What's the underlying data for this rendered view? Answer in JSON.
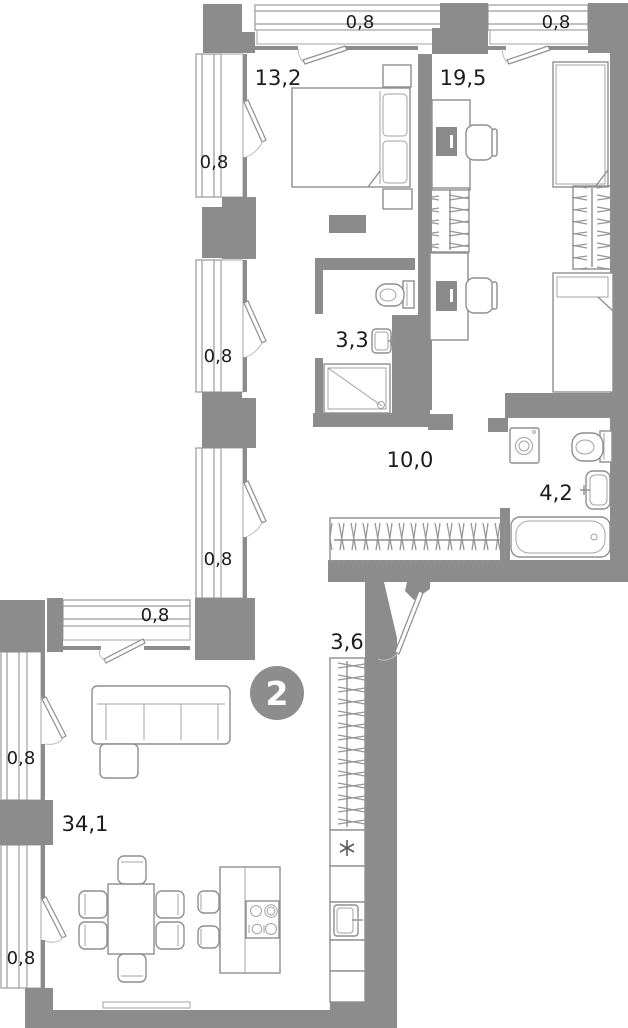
{
  "plan": {
    "type": "apartment-floor-plan",
    "badge": {
      "label": "2"
    },
    "rooms": [
      {
        "name": "bedroom",
        "area": "13,2",
        "furniture": [
          "double-bed",
          "nightstand",
          "nightstand",
          "tv-stand"
        ]
      },
      {
        "name": "bedroom-2",
        "area": "19,5",
        "furniture": [
          "desk",
          "office-chair",
          "wardrobe",
          "desk",
          "office-chair",
          "single-bed",
          "wardrobe",
          "single-bed"
        ]
      },
      {
        "name": "shower-room",
        "area": "3,3",
        "furniture": [
          "toilet",
          "washbasin",
          "shower-tray"
        ]
      },
      {
        "name": "hallway",
        "area": "10,0",
        "furniture": [
          "wardrobe-hangers"
        ]
      },
      {
        "name": "bathroom",
        "area": "4,2",
        "furniture": [
          "washing-machine",
          "toilet",
          "washbasin",
          "bathtub"
        ]
      },
      {
        "name": "entry-corridor",
        "area": "3,6",
        "furniture": [
          "wardrobe-hangers",
          "entrance-door"
        ]
      },
      {
        "name": "living-kitchen",
        "area": "34,1",
        "furniture": [
          "corner-sofa",
          "dining-table",
          "six-chairs",
          "kitchen-island",
          "cooktop",
          "two-stools",
          "fridge",
          "kitchen-sink",
          "kitchen-cabinets",
          "radiator"
        ]
      }
    ],
    "balconies": [
      {
        "name": "balcony-top-1",
        "area": "0,8"
      },
      {
        "name": "balcony-top-2",
        "area": "0,8"
      },
      {
        "name": "balcony-left-1",
        "area": "0,8"
      },
      {
        "name": "balcony-left-2",
        "area": "0,8"
      },
      {
        "name": "balcony-left-3",
        "area": "0,8"
      },
      {
        "name": "balcony-lower-top",
        "area": "0,8"
      },
      {
        "name": "balcony-lower-left-1",
        "area": "0,8"
      },
      {
        "name": "balcony-lower-left-2",
        "area": "0,8"
      }
    ],
    "colors": {
      "wall": "#8c8c8c",
      "furniture_line": "#8f8f8f",
      "text": "#1c1c1c",
      "badge": "#8d8d8d",
      "badge_text": "#ffffff",
      "background": "#ffffff"
    }
  }
}
